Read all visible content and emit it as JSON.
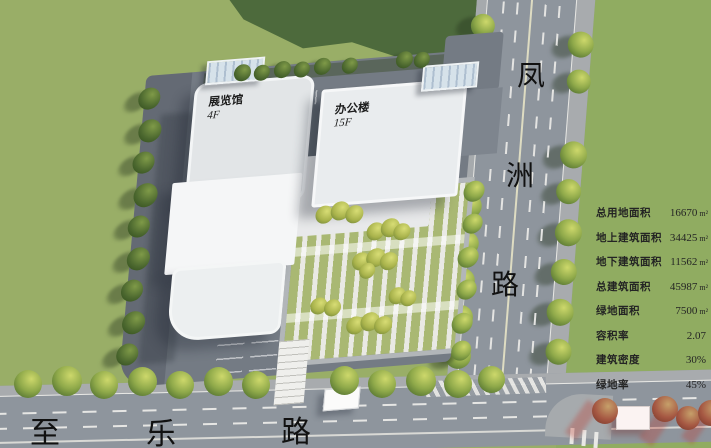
{
  "buildings": [
    {
      "name": "展览馆",
      "floors": "4F"
    },
    {
      "name": "办公楼",
      "floors": "15F"
    }
  ],
  "roads": [
    {
      "name": "凤洲路",
      "chars": [
        "凤",
        "洲",
        "路"
      ],
      "orientation": "vertical"
    },
    {
      "name": "至乐路",
      "chars": [
        "至",
        "乐",
        "路"
      ],
      "orientation": "horizontal"
    }
  ],
  "stats": {
    "rows": [
      {
        "label": "总用地面积",
        "value": "16670",
        "unit": "m²"
      },
      {
        "label": "地上建筑面积",
        "value": "34425",
        "unit": "m²"
      },
      {
        "label": "地下建筑面积",
        "value": "11562",
        "unit": "m²"
      },
      {
        "label": "总建筑面积",
        "value": "45987",
        "unit": "m²"
      },
      {
        "label": "绿地面积",
        "value": "7500",
        "unit": "m²"
      },
      {
        "label": "容积率",
        "value": "2.07",
        "unit": ""
      },
      {
        "label": "建筑密度",
        "value": "30%",
        "unit": ""
      },
      {
        "label": "绿地率",
        "value": "45%",
        "unit": ""
      }
    ]
  },
  "colors": {
    "grass": "#99ae67",
    "dark_green": "#4d6a3c",
    "road": "#8e959d",
    "plaza": "#747b84",
    "building_white": "#f3f4f5",
    "text": "#1a1a1a"
  }
}
